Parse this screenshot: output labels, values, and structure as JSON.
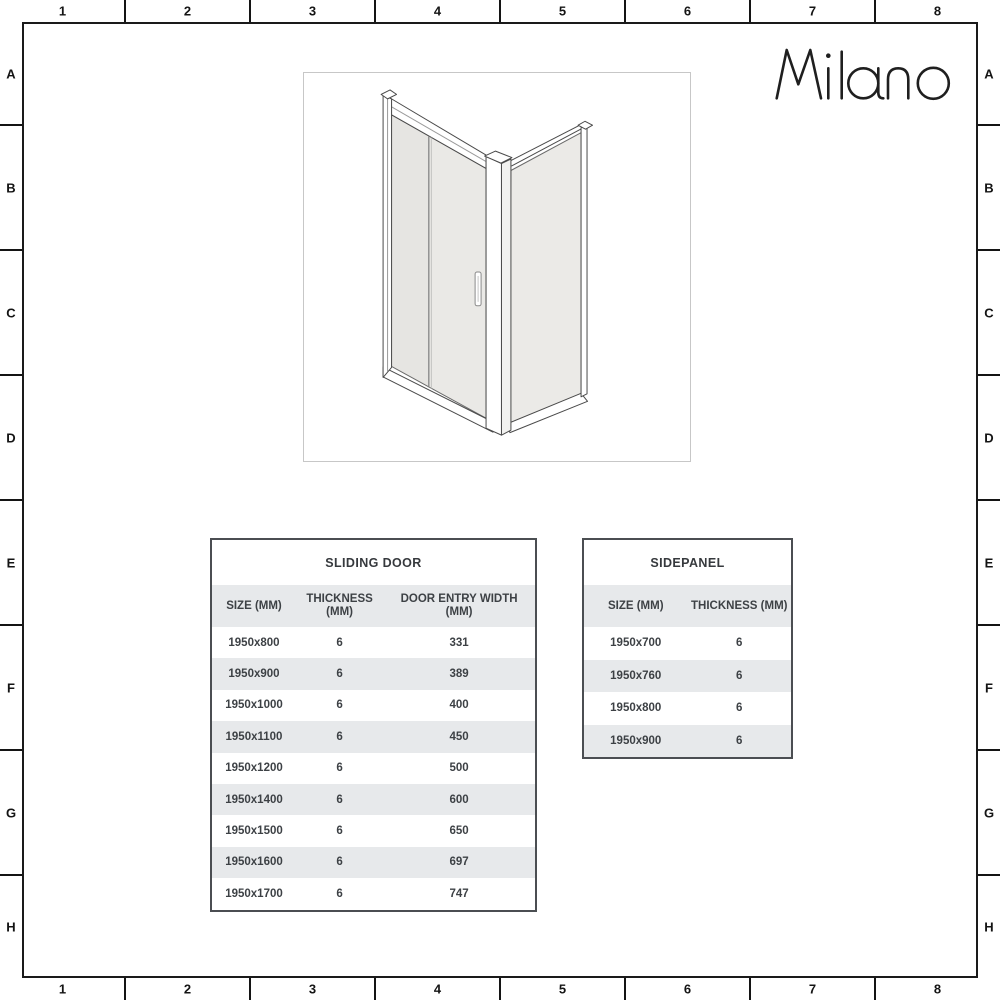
{
  "sheet": {
    "brand": "Milano",
    "grid": {
      "columns": [
        "1",
        "2",
        "3",
        "4",
        "5",
        "6",
        "7",
        "8"
      ],
      "rows": [
        "A",
        "B",
        "C",
        "D",
        "E",
        "F",
        "G",
        "H"
      ]
    }
  },
  "drawing": {
    "icon": "sliding-door-with-side-panel-isometric-drawing"
  },
  "tables": {
    "sliding_door": {
      "title": "SLIDING DOOR",
      "columns": [
        "SIZE (MM)",
        "THICKNESS (MM)",
        "DOOR ENTRY WIDTH (MM)"
      ],
      "rows": [
        [
          "1950x800",
          "6",
          "331"
        ],
        [
          "1950x900",
          "6",
          "389"
        ],
        [
          "1950x1000",
          "6",
          "400"
        ],
        [
          "1950x1100",
          "6",
          "450"
        ],
        [
          "1950x1200",
          "6",
          "500"
        ],
        [
          "1950x1400",
          "6",
          "600"
        ],
        [
          "1950x1500",
          "6",
          "650"
        ],
        [
          "1950x1600",
          "6",
          "697"
        ],
        [
          "1950x1700",
          "6",
          "747"
        ]
      ]
    },
    "sidepanel": {
      "title": "SIDEPANEL",
      "columns": [
        "SIZE (MM)",
        "THICKNESS (MM)"
      ],
      "rows": [
        [
          "1950x700",
          "6"
        ],
        [
          "1950x760",
          "6"
        ],
        [
          "1950x800",
          "6"
        ],
        [
          "1950x900",
          "6"
        ]
      ]
    }
  },
  "colors": {
    "frame_line": "#1a1a1a",
    "table_border": "#4b4e52",
    "table_row_alt": "#e7e9eb",
    "table_text": "#3d4145",
    "glass": "#eae9e6",
    "drawing_line": "#4a4a4a",
    "drawing_box_border": "#c7c7c7"
  }
}
